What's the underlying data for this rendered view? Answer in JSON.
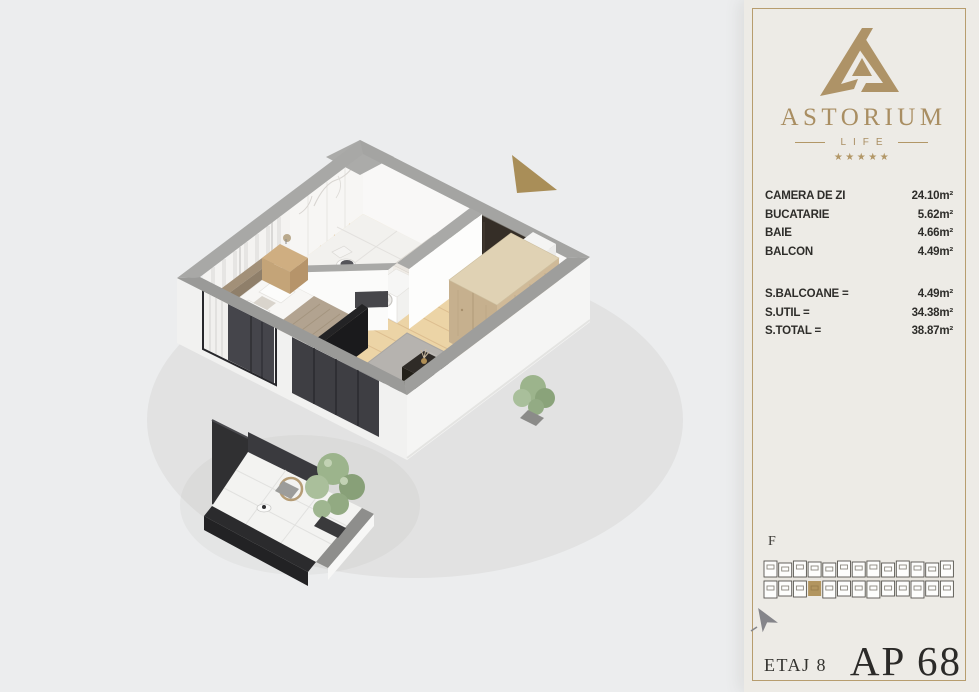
{
  "panel": {
    "brand": {
      "name": "ASTORIUM",
      "sub": "LIFE",
      "stars": "★★★★★"
    },
    "rooms": [
      {
        "label": "CAMERA DE ZI",
        "value": "24.10m²"
      },
      {
        "label": "BUCATARIE",
        "value": "5.62m²"
      },
      {
        "label": "BAIE",
        "value": "4.66m²"
      },
      {
        "label": "BALCON",
        "value": "4.49m²"
      }
    ],
    "totals": [
      {
        "label": "S.BALCOANE =",
        "value": "4.49m²"
      },
      {
        "label": "S.UTIL =",
        "value": "34.38m²"
      },
      {
        "label": "S.TOTAL =",
        "value": "38.87m²"
      }
    ],
    "locator": {
      "block_label": "F"
    },
    "footer": {
      "floor": "ETAJ 8",
      "apartment": "AP 68"
    }
  },
  "colors": {
    "gold": "#ae9367",
    "panel_background": "#edebe6",
    "canvas_background": "#ecedee",
    "text_dark": "#2e2d2a",
    "wall_gray": "#a1a19f",
    "wood_floor": "#ecd4a6",
    "rug_gray": "#b6b3af",
    "plant_green": "#9cb48c",
    "fixture_dark": "#29292b",
    "direction_arrow": "#a98e58",
    "highlight_unit": "#b2955f"
  }
}
